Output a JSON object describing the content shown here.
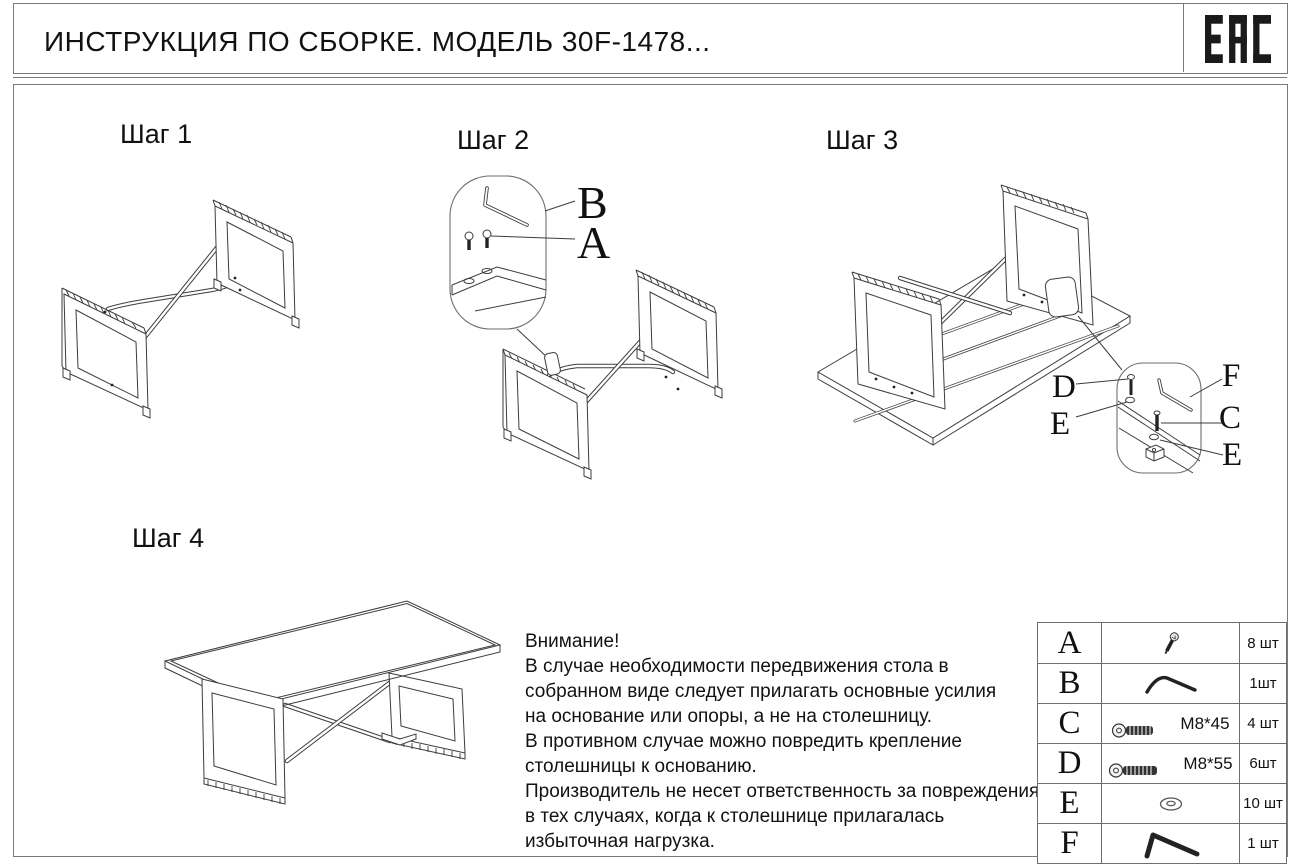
{
  "header": {
    "title": "ИНСТРУКЦИЯ ПО СБОРКЕ. МОДЕЛЬ 30F-1478...",
    "certification_mark": "EAC"
  },
  "steps": [
    {
      "label": "Шаг 1"
    },
    {
      "label": "Шаг 2",
      "callouts": {
        "b": "B",
        "a": "A"
      }
    },
    {
      "label": "Шаг 3",
      "callouts": {
        "d": "D",
        "e1": "E",
        "f": "F",
        "c": "C",
        "e2": "E"
      }
    },
    {
      "label": "Шаг 4"
    }
  ],
  "warning": {
    "lines": [
      "Внимание!",
      "В случае необходимости передвижения стола в",
      "собранном виде следует прилагать основные усилия",
      "на основание или опоры, а не на столешницу.",
      "В противном случае можно повредить крепление",
      "столешницы к основанию.",
      "Производитель не несет ответственность за повреждения",
      "в тех случаях, когда к столешнице прилагалась",
      "избыточная нагрузка."
    ]
  },
  "parts_table": {
    "rows": [
      {
        "id": "A",
        "spec": "",
        "qty": "8 шт",
        "icon": "screw-icon"
      },
      {
        "id": "B",
        "spec": "",
        "qty": "1шт",
        "icon": "hex-key-icon"
      },
      {
        "id": "C",
        "spec": "M8*45",
        "qty": "4 шт",
        "icon": "bolt-icon"
      },
      {
        "id": "D",
        "spec": "M8*55",
        "qty": "6шт",
        "icon": "bolt-icon"
      },
      {
        "id": "E",
        "spec": "",
        "qty": "10 шт",
        "icon": "washer-icon"
      },
      {
        "id": "F",
        "spec": "",
        "qty": "1 шт",
        "icon": "hex-key-icon"
      }
    ]
  },
  "colors": {
    "line": "#3d3d3d",
    "text": "#111111",
    "border": "#7a7a7a"
  }
}
